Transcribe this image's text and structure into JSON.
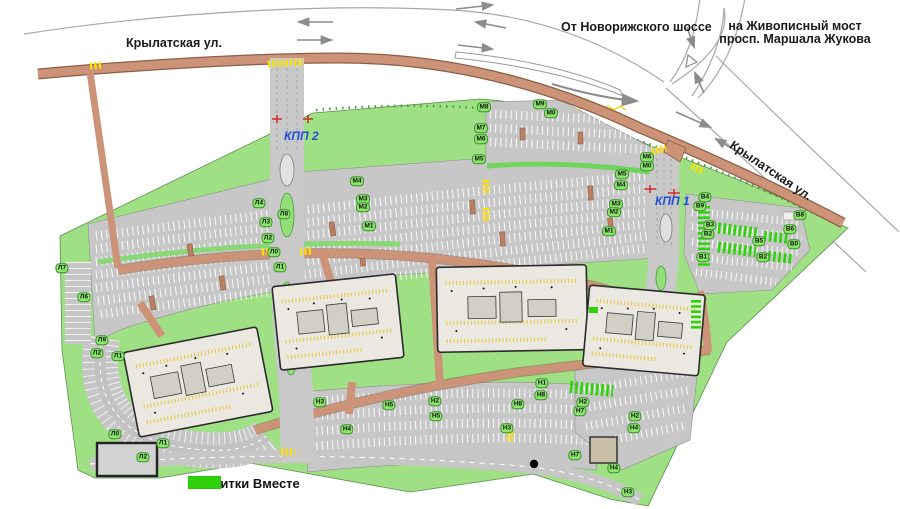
{
  "roads": {
    "street_top_label": "Крылатская ул.",
    "street_right_label": "Крылатская ул.",
    "from_highway_label": "От新",
    "from_highway_label_fix": "От Новорижского шоссе",
    "to_bridge_line1": "на Живописный мост",
    "to_bridge_line2": "просп. Маршала Жукова"
  },
  "checkpoints": {
    "kpp1": "КПП 1",
    "kpp2": "КПП 2"
  },
  "legend": {
    "label": "- Напитки Вместе",
    "swatch_color": "#2ed409"
  },
  "colors": {
    "site_green": "#9fe085",
    "drinks_green": "#2ed409",
    "road_salmon": "#cd9378",
    "asphalt": "#c7c7c7",
    "kpp_blue": "#1d4fd7",
    "crosswalk_yellow": "#ffe000"
  },
  "map_labels": [
    {
      "t": "М8",
      "x": 484,
      "y": 107
    },
    {
      "t": "М9",
      "x": 540,
      "y": 104
    },
    {
      "t": "М0",
      "x": 551,
      "y": 113
    },
    {
      "t": "М7",
      "x": 481,
      "y": 128
    },
    {
      "t": "М6",
      "x": 481,
      "y": 139
    },
    {
      "t": "М5",
      "x": 479,
      "y": 159
    },
    {
      "t": "М4",
      "x": 357,
      "y": 181
    },
    {
      "t": "М3",
      "x": 363,
      "y": 199
    },
    {
      "t": "М2",
      "x": 363,
      "y": 207
    },
    {
      "t": "М1",
      "x": 369,
      "y": 226
    },
    {
      "t": "М6",
      "x": 647,
      "y": 157
    },
    {
      "t": "М0",
      "x": 647,
      "y": 166
    },
    {
      "t": "М5",
      "x": 622,
      "y": 174
    },
    {
      "t": "М4",
      "x": 621,
      "y": 185
    },
    {
      "t": "М3",
      "x": 616,
      "y": 204
    },
    {
      "t": "М2",
      "x": 614,
      "y": 212
    },
    {
      "t": "М1",
      "x": 609,
      "y": 231
    },
    {
      "t": "Л4",
      "x": 259,
      "y": 203
    },
    {
      "t": "Л8",
      "x": 284,
      "y": 214
    },
    {
      "t": "Л3",
      "x": 266,
      "y": 222
    },
    {
      "t": "Л2",
      "x": 268,
      "y": 238
    },
    {
      "t": "Л0",
      "x": 274,
      "y": 252
    },
    {
      "t": "Л1",
      "x": 280,
      "y": 267
    },
    {
      "t": "Л7",
      "x": 62,
      "y": 268
    },
    {
      "t": "Л6",
      "x": 84,
      "y": 297
    },
    {
      "t": "Л9",
      "x": 102,
      "y": 340
    },
    {
      "t": "Л2",
      "x": 97,
      "y": 353
    },
    {
      "t": "Л1",
      "x": 118,
      "y": 356
    },
    {
      "t": "Л0",
      "x": 115,
      "y": 434
    },
    {
      "t": "Л1",
      "x": 163,
      "y": 443
    },
    {
      "t": "Л2",
      "x": 143,
      "y": 457
    },
    {
      "t": "Н3",
      "x": 320,
      "y": 402
    },
    {
      "t": "Н5",
      "x": 389,
      "y": 405
    },
    {
      "t": "Н2",
      "x": 435,
      "y": 401
    },
    {
      "t": "Н5",
      "x": 436,
      "y": 416
    },
    {
      "t": "Н4",
      "x": 347,
      "y": 429
    },
    {
      "t": "Н8",
      "x": 518,
      "y": 404
    },
    {
      "t": "Н3",
      "x": 507,
      "y": 428
    },
    {
      "t": "Н1",
      "x": 542,
      "y": 383
    },
    {
      "t": "Н8",
      "x": 541,
      "y": 395
    },
    {
      "t": "Н7",
      "x": 580,
      "y": 411
    },
    {
      "t": "Н2",
      "x": 583,
      "y": 402
    },
    {
      "t": "Н2",
      "x": 635,
      "y": 416
    },
    {
      "t": "Н4",
      "x": 634,
      "y": 428
    },
    {
      "t": "Н7",
      "x": 575,
      "y": 455
    },
    {
      "t": "Н4",
      "x": 614,
      "y": 468
    },
    {
      "t": "Н3",
      "x": 628,
      "y": 492
    },
    {
      "t": "В4",
      "x": 705,
      "y": 197
    },
    {
      "t": "В9",
      "x": 700,
      "y": 206
    },
    {
      "t": "В3",
      "x": 710,
      "y": 225
    },
    {
      "t": "В2",
      "x": 708,
      "y": 234
    },
    {
      "t": "В1",
      "x": 703,
      "y": 257
    },
    {
      "t": "В5",
      "x": 759,
      "y": 241
    },
    {
      "t": "В6",
      "x": 790,
      "y": 229
    },
    {
      "t": "В0",
      "x": 794,
      "y": 244
    },
    {
      "t": "В2",
      "x": 763,
      "y": 257
    },
    {
      "t": "В8",
      "x": 800,
      "y": 215
    }
  ]
}
